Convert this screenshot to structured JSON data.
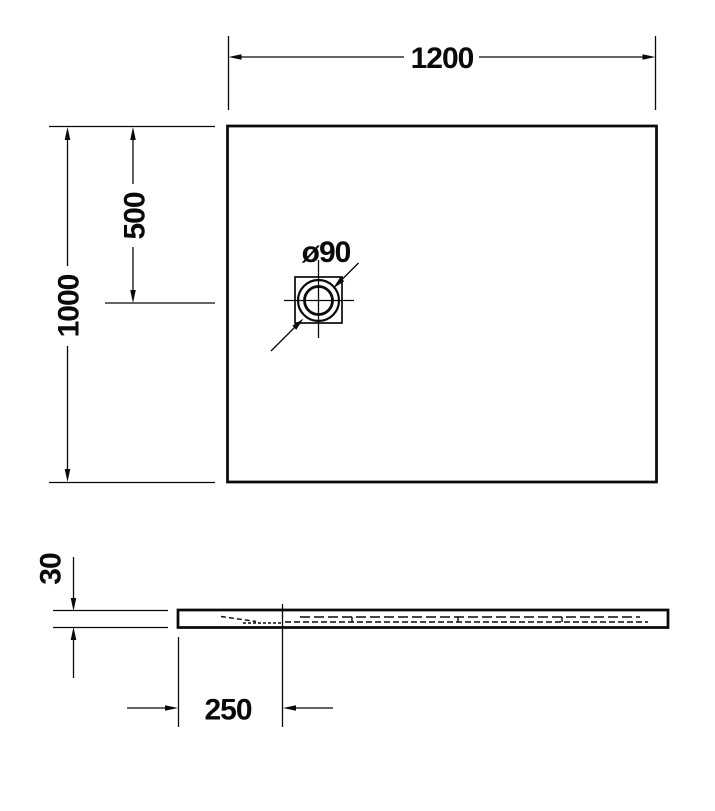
{
  "drawing": {
    "kind": "technical-dimension-drawing",
    "views": {
      "top": {
        "width": "1200",
        "height": "1000",
        "drain_offset_from_top": "500",
        "drain_diameter": "ø90"
      },
      "section": {
        "thickness": "30",
        "drain_center_from_left": "250"
      }
    },
    "colors": {
      "line": "#0a0a0a",
      "background": "#ffffff"
    }
  }
}
